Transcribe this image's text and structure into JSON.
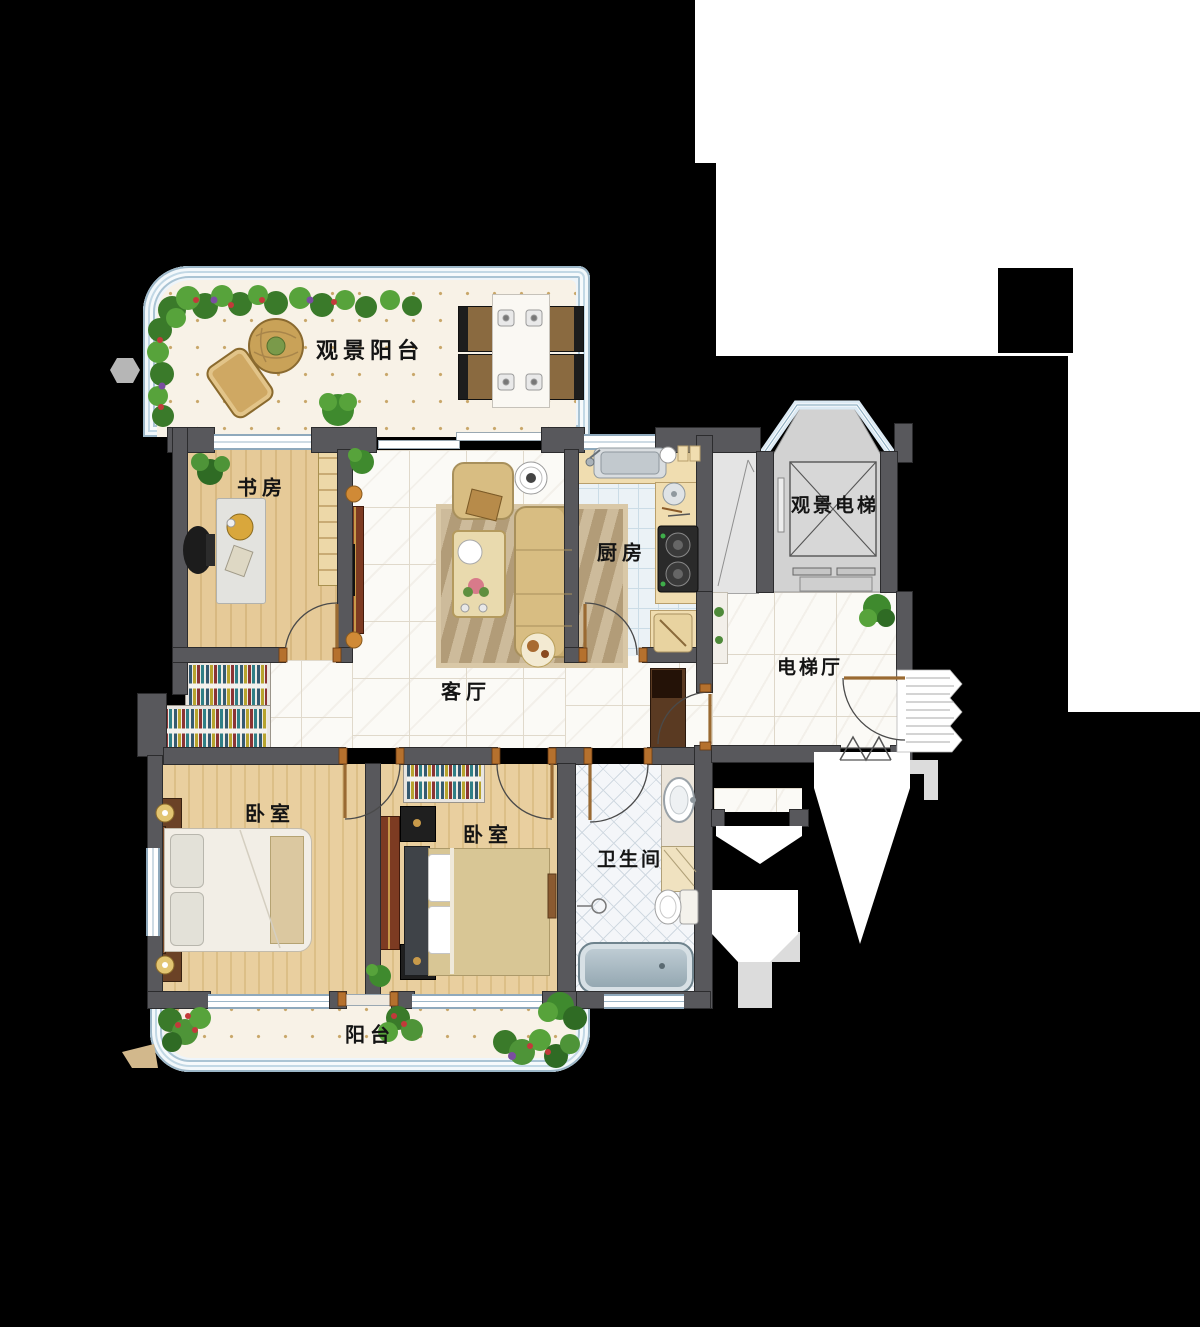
{
  "plan_title": "apartment-floor-plan",
  "rooms": {
    "view_balcony": {
      "label": "观景阳台"
    },
    "study": {
      "label": "书房"
    },
    "living": {
      "label": "客厅"
    },
    "kitchen": {
      "label": "厨房"
    },
    "elevator": {
      "label": "观景电梯"
    },
    "elevator_hall": {
      "label": "电梯厅"
    },
    "bedroom_main": {
      "label": "卧室"
    },
    "bedroom_second": {
      "label": "卧室"
    },
    "bathroom": {
      "label": "卫生间"
    },
    "balcony": {
      "label": "阳台"
    }
  },
  "colors": {
    "background": "#000000",
    "wall": "#58585c",
    "wood_floor": "#e0c28e",
    "marble_floor": "#fbfaf6",
    "kitchen_tile": "#ebf2f6",
    "bath_tile": "#f4f6f9",
    "balcony_floor": "#f8f2e7",
    "window_frame_blue": "#aac4d4",
    "elevator_cab": "#d2d2d2",
    "counter_beige": "#f0ddb0",
    "sofa_gold": "#d8bd82",
    "door_jamb": "#b5712e"
  }
}
